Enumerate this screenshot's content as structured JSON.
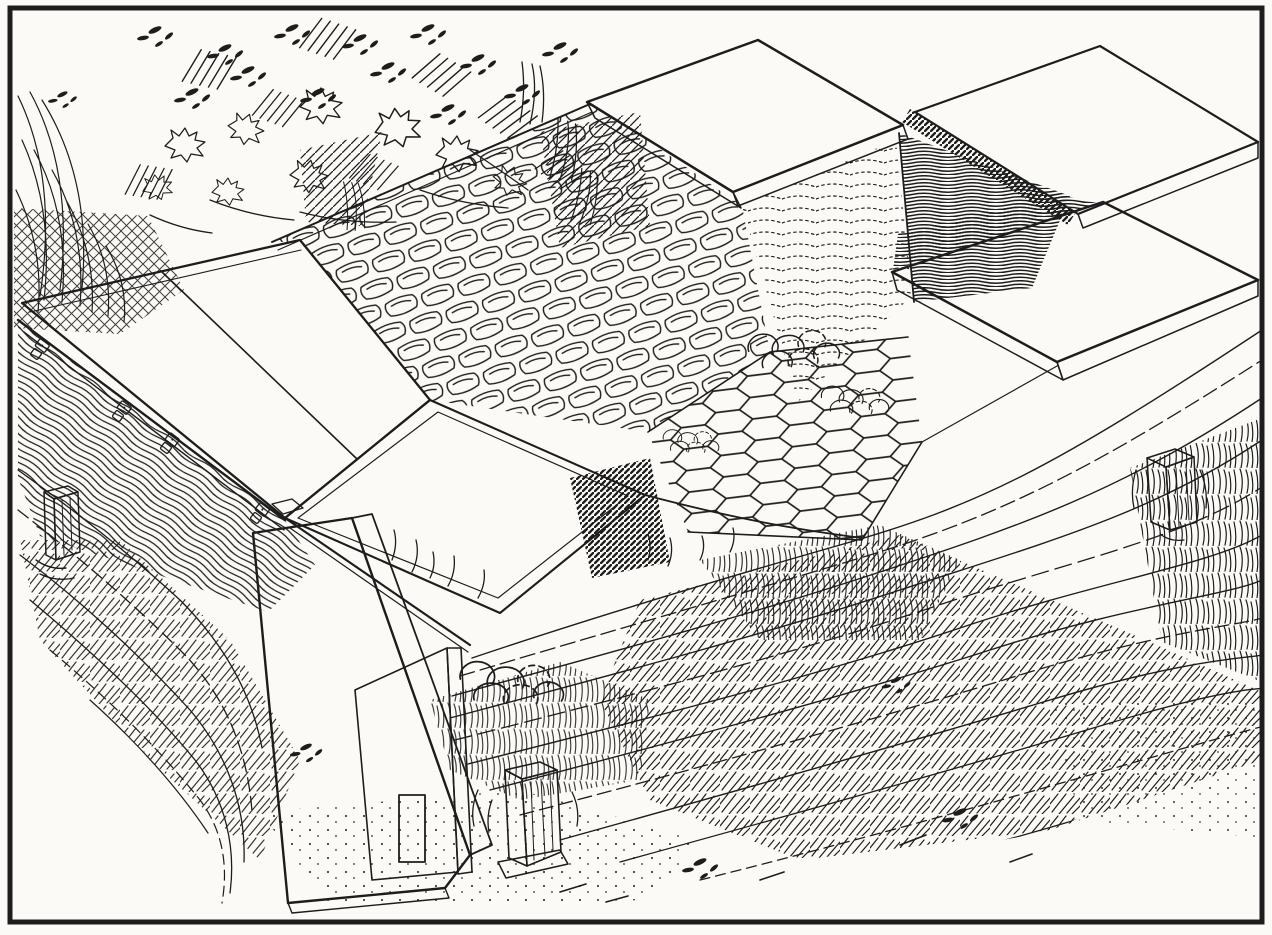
{
  "canvas": {
    "width": 1272,
    "height": 935
  },
  "palette": {
    "paper": "#fbfaf6",
    "ink": "#1d1d1d"
  },
  "figure": {
    "kind": "pen-and-ink book engraving, no visible text or caption",
    "alt": "Engraving of a long sunken cold-frame pit built into a grassy bank. The left bay is covered by two white sashes hinged to a wood-grain front wall; the middle of the deck is covered with overlapping flat stones and a patch of hexagonal wire netting over lumpy stones; a raised white sash slab and plain wooden board covers lie over open dark pits at the upper right; a second white sash slab sits at the far right. A wide plank leans against the left gable end, which has a small white access door. Small white wooden vent posts stand at the left wall, in the foreground, and on the right bank. Shrubs and scribbled foliage fill the upper-left background and wavy contour lines with grass tufts fill the foreground bank."
  },
  "elements": {
    "frame_border": "rectangular ink border of the plate",
    "background_shrubs": "scribbled bushes, leaf blobs and hatch bundles, upper left",
    "left_grass_fan": "radiating grass strokes along the left edge",
    "crosshatch_bank_patch": "cross-hatched bank patch at left margin",
    "front_wall": "wood-grain front wall of the frame",
    "left_sash_pair": "two white sashes with center seam",
    "hinges": "four small hinge plates on the front edge",
    "thatch_slope": "deck slope covered with overlapping flat stones",
    "raised_sash_slab": "raised white sash slab, top middle",
    "stipple_slope": "dotted earth slope beside the raised slab",
    "open_pit_wall": "dark wood-grain wall of an open pit, upper right",
    "wood_board_cover": "plain wooden board cover, top right",
    "pit_band_woodgrain": "wood-grain band above the right sash slab",
    "right_sash_slab": "white sash slab at far right",
    "wire_netting_patch": "hexagonal wire netting over stones",
    "stone_mounds": "clusters of rounded stones",
    "open_bed_stipple": "open stippled bed between rails",
    "shadow_wedge": "dark hatched shadow wedge",
    "gable_end": "dark hatched gable end of the frame",
    "access_door": "small white door opening in the gable",
    "corner_post": "rung-hatched corner post",
    "leaning_plank": "wide wood-grain plank leaning on the left end",
    "vent_post_left": "small white post at the left wall",
    "vent_post_middle": "white vent post in the foreground",
    "vent_post_right": "white vent post on the right bank",
    "foreground_bank": "sweeping wavy contour lines of the bank",
    "grass_patches": "stroked grass tufts",
    "stipple_ground": "sparse dotted ground at the bottom",
    "deck_rails": "white rail edges of the deck"
  }
}
